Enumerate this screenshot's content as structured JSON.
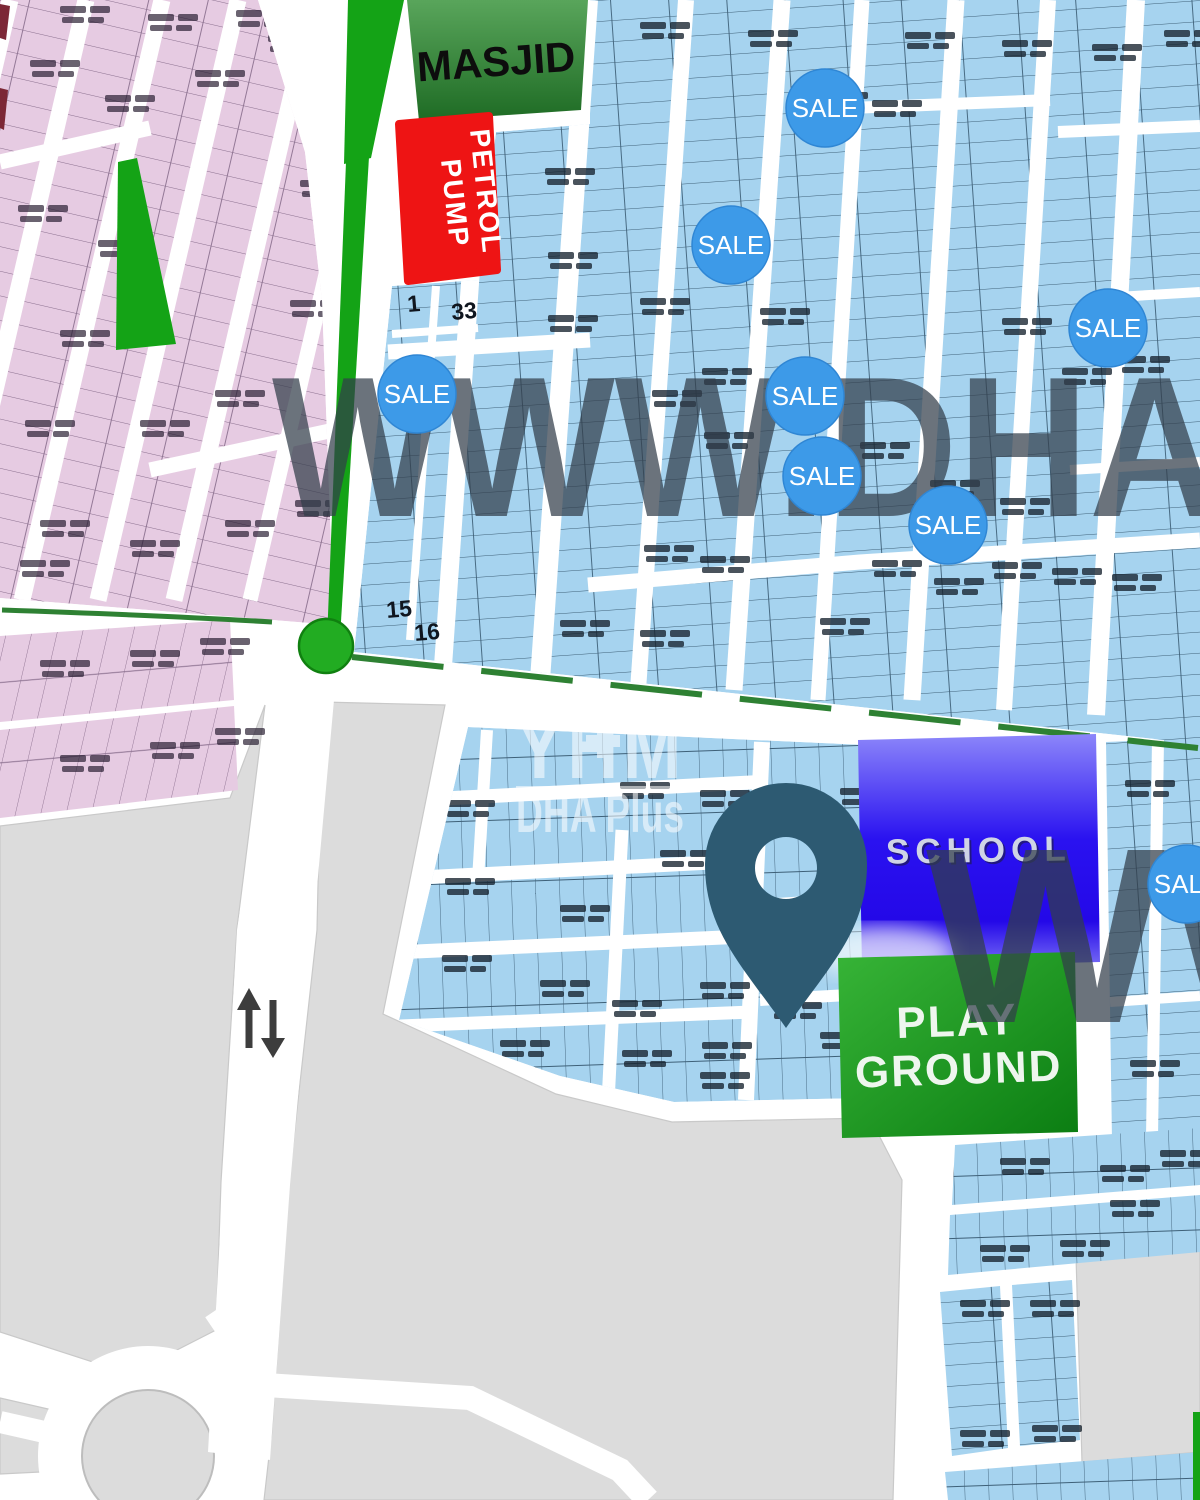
{
  "map": {
    "landmarks": {
      "masjid": "MASJID",
      "petrol_line1": "PETROL",
      "petrol_line2": "PUMP",
      "school": "SCHOOL",
      "playground_line1": "PLAY",
      "playground_line2": "GROUND"
    },
    "sale_label": "SALE",
    "sale_badges": [
      {
        "x": 825,
        "y": 108
      },
      {
        "x": 731,
        "y": 245
      },
      {
        "x": 1108,
        "y": 328
      },
      {
        "x": 417,
        "y": 394
      },
      {
        "x": 805,
        "y": 396
      },
      {
        "x": 822,
        "y": 476
      },
      {
        "x": 948,
        "y": 525
      },
      {
        "x": 1187,
        "y": 884
      }
    ],
    "plot_numbers": [
      {
        "text": "1",
        "x": 408,
        "y": 312
      },
      {
        "text": "33",
        "x": 452,
        "y": 320
      },
      {
        "text": "15",
        "x": 387,
        "y": 618
      },
      {
        "text": "16",
        "x": 415,
        "y": 641
      }
    ],
    "watermarks": {
      "top": "WWW.DHA",
      "bottom": "WW",
      "logo_glyphs": "YHM",
      "logo_text": "DHA Plus"
    },
    "colors": {
      "plot_blue": "#a6d3ef",
      "plot_pink": "#e6cbe2",
      "sale_blue": "#3d9ae8",
      "road_green": "#14a316",
      "petrol_red": "#ee1414",
      "masjid_green": "#2f7d33",
      "school_blue": "#2a12f0",
      "playground_green": "#149114",
      "pin_teal": "#2d5a72",
      "gray_block": "#dcdcdc",
      "watermark_gray": "#323e4a"
    }
  }
}
